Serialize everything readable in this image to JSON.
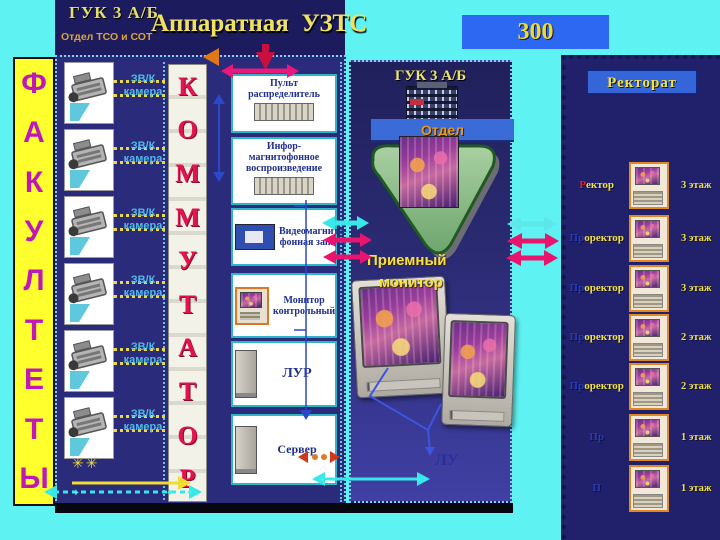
{
  "header": {
    "guk": "ГУК 3 А/Б",
    "dept": "Отдел ТСО и СОТ",
    "title": "Аппаратная  УЗТС"
  },
  "badge_300": "300",
  "faculties": {
    "letters": [
      "Ф",
      "А",
      "К",
      "У",
      "Л",
      "Т",
      "Е",
      "Т",
      "Ы"
    ]
  },
  "cameras": {
    "count": 6,
    "label_line1": "ЗВ/К",
    "label_line2": "камера"
  },
  "kommutator": {
    "letters": [
      "К",
      "О",
      "М",
      "М",
      "У",
      "Т",
      "А",
      "Т",
      "О",
      "Р"
    ]
  },
  "equipment": {
    "boxes": [
      {
        "title": "Пульт распределитель"
      },
      {
        "title": "Инфор-магнитофонное воспроизведение"
      },
      {
        "title": "Видеомагнито-фонная запись"
      },
      {
        "title": "Монитор контрольный"
      },
      {
        "title": "ЛУР"
      },
      {
        "title": "Сервер"
      }
    ]
  },
  "center": {
    "guk": "ГУК 3 А/Б",
    "otdel": "Отдел",
    "reception_line1": "Приемный",
    "reception_line2": "монитор",
    "lu": "ЛУ"
  },
  "rectorate": {
    "title": "Ректорат",
    "rows": [
      {
        "prefix": "Р",
        "rest": "ектор",
        "floor": "3 этаж"
      },
      {
        "prefix": "Пр",
        "rest": "оректор",
        "floor": "3 этаж"
      },
      {
        "prefix": "Пр",
        "rest": "оректор",
        "floor": "3 этаж"
      },
      {
        "prefix": "Пр",
        "rest": "оректор",
        "floor": "2 этаж"
      },
      {
        "prefix": "Пр",
        "rest": "оректор",
        "floor": "2 этаж"
      },
      {
        "prefix": "Пр",
        "rest": "",
        "floor": "1 этаж"
      },
      {
        "prefix": "П",
        "rest": "",
        "floor": "1 этаж"
      }
    ]
  },
  "decor": {
    "star": "✳✳",
    "sparkle": "✦"
  },
  "colors": {
    "background_cyan": "#5FF2F2",
    "panel_navy": "#2B2B7B",
    "strip_yellow": "#FFFF2E",
    "letter_magenta": "#C018B8",
    "kommutator_red": "#E11450",
    "arrow_magenta": "#E8146E",
    "arrow_cyan": "#38E8E8",
    "arrow_yellow": "#EEDE30",
    "bar_blue": "#3A6BD6",
    "text_yellow": "#F0E040"
  }
}
